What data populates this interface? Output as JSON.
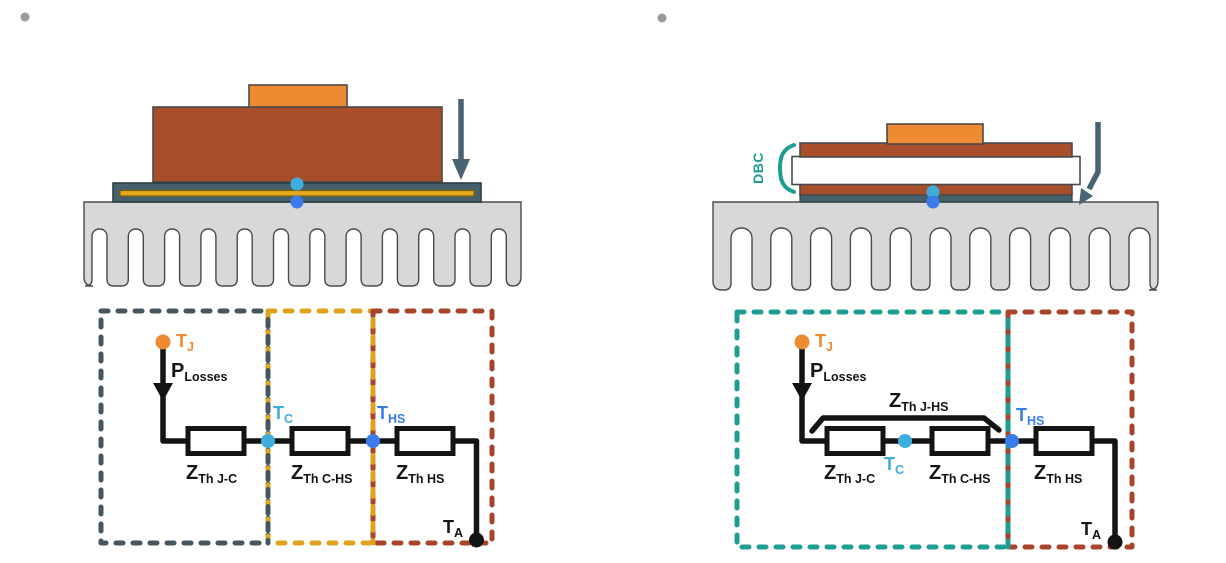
{
  "colors": {
    "orange": "#EE8A31",
    "rust": "#A94E2B",
    "slate_fill": "#46606B",
    "slate_dark": "#2F3E46",
    "steel": "#486472",
    "gold": "#E4A91C",
    "gold_dark": "#806000",
    "dash_slate": "#44565F",
    "dash_yellow": "#DFA21E",
    "dash_red": "#A9432A",
    "teal": "#1E9E92",
    "light_blue": "#3FAEDC",
    "blue": "#3C7CEA",
    "heatsink": "#D8D8D8",
    "outline": "#4A4A4A",
    "black": "#141414",
    "bullet": "#9A9A9A",
    "white": "#FFFFFF"
  },
  "left": {
    "circuit": {
      "t_j": {
        "base": "T",
        "sub": "J"
      },
      "p_losses": {
        "base": "P",
        "sub": "Losses"
      },
      "z_th_jc": {
        "base": "Z",
        "sub": "Th J-C"
      },
      "t_c": {
        "base": "T",
        "sub": "C"
      },
      "z_th_chs": {
        "base": "Z",
        "sub": "Th C-HS"
      },
      "t_hs": {
        "base": "T",
        "sub": "HS"
      },
      "z_th_hs": {
        "base": "Z",
        "sub": "Th HS"
      },
      "t_a": {
        "base": "T",
        "sub": "A"
      }
    }
  },
  "right": {
    "physical": {
      "dbc_label": "DBC"
    },
    "circuit": {
      "t_j": {
        "base": "T",
        "sub": "J"
      },
      "p_losses": {
        "base": "P",
        "sub": "Losses"
      },
      "z_th_jhs": {
        "base": "Z",
        "sub": "Th J-HS"
      },
      "z_th_jc": {
        "base": "Z",
        "sub": "Th J-C"
      },
      "t_c": {
        "base": "T",
        "sub": "C"
      },
      "z_th_chs": {
        "base": "Z",
        "sub": "Th C-HS"
      },
      "t_hs": {
        "base": "T",
        "sub": "HS"
      },
      "z_th_hs": {
        "base": "Z",
        "sub": "Th HS"
      },
      "t_a": {
        "base": "T",
        "sub": "A"
      }
    }
  }
}
